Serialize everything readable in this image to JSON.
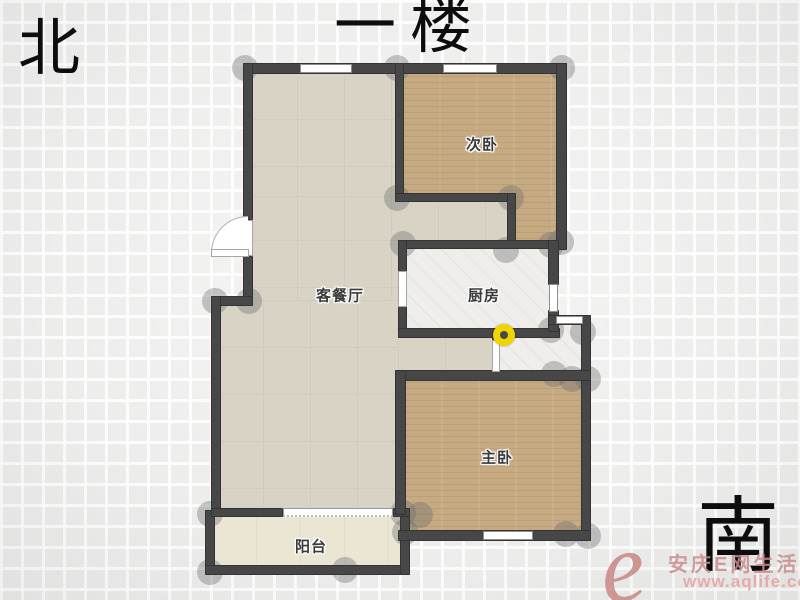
{
  "title": "一楼",
  "compass": {
    "north": "北",
    "south": "南"
  },
  "rooms": {
    "secondary_bedroom": "次卧",
    "living_dining": "客餐厅",
    "kitchen": "厨房",
    "master_bedroom": "主卧",
    "balcony": "阳台"
  },
  "watermark": {
    "logo": "e",
    "site_name": "安庆E网生活",
    "url": "www.aqlife.com"
  },
  "colors": {
    "wall": "#474747",
    "wood_floor": "#c6aa82",
    "living_tile": "#d8d3c5",
    "white_tile": "#efeeeb",
    "balcony_floor": "#ebe5d3",
    "door_pivot_yellow": "#f0d400",
    "watermark_red": "#c5817e"
  }
}
